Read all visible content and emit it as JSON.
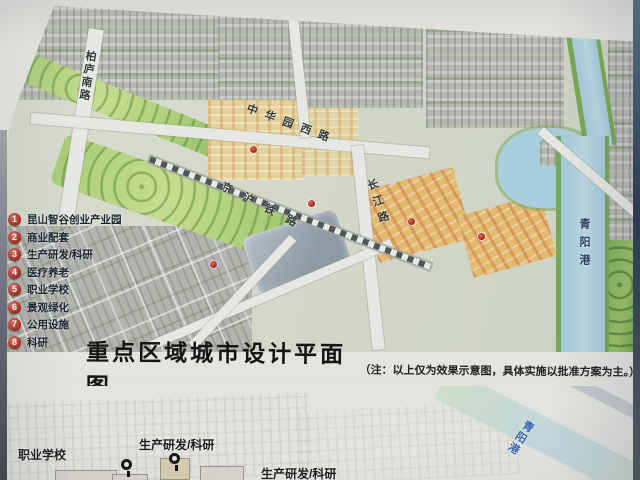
{
  "legend": {
    "items": [
      {
        "num": "1",
        "label": "昆山智谷创业产业园"
      },
      {
        "num": "2",
        "label": "商业配套"
      },
      {
        "num": "3",
        "label": "生产研发/科研"
      },
      {
        "num": "4",
        "label": "医疗养老"
      },
      {
        "num": "5",
        "label": "职业学校"
      },
      {
        "num": "6",
        "label": "景观绿化"
      },
      {
        "num": "7",
        "label": "公用设施"
      },
      {
        "num": "8",
        "label": "科研"
      }
    ]
  },
  "map": {
    "road_labels": {
      "bailu": "柏庐南路",
      "zhonghua": "中华园西路",
      "railway": "京沪铁路",
      "changjiang": "长江路",
      "qingyang": "青阳港"
    },
    "colors": {
      "water": "#aecfdd",
      "park": "#7cb155",
      "block_gray": "#b6b7b1",
      "block_tan": "#e3d29b",
      "block_yellow": "#e2bb71",
      "road": "#e7e8e3",
      "marker_red": "#a5231a"
    }
  },
  "caption": {
    "title": "重点区域城市设计平面图",
    "note": "（注：以上仅为效果示意图，具体实施以批准方案为主。）"
  },
  "bottom_figure": {
    "labels": [
      {
        "text": "职业学校"
      },
      {
        "text": "生产研发/科研"
      },
      {
        "text": "生产研发/科研"
      }
    ],
    "river_label": "青阳港",
    "river_label_color": "#3b63ad"
  }
}
